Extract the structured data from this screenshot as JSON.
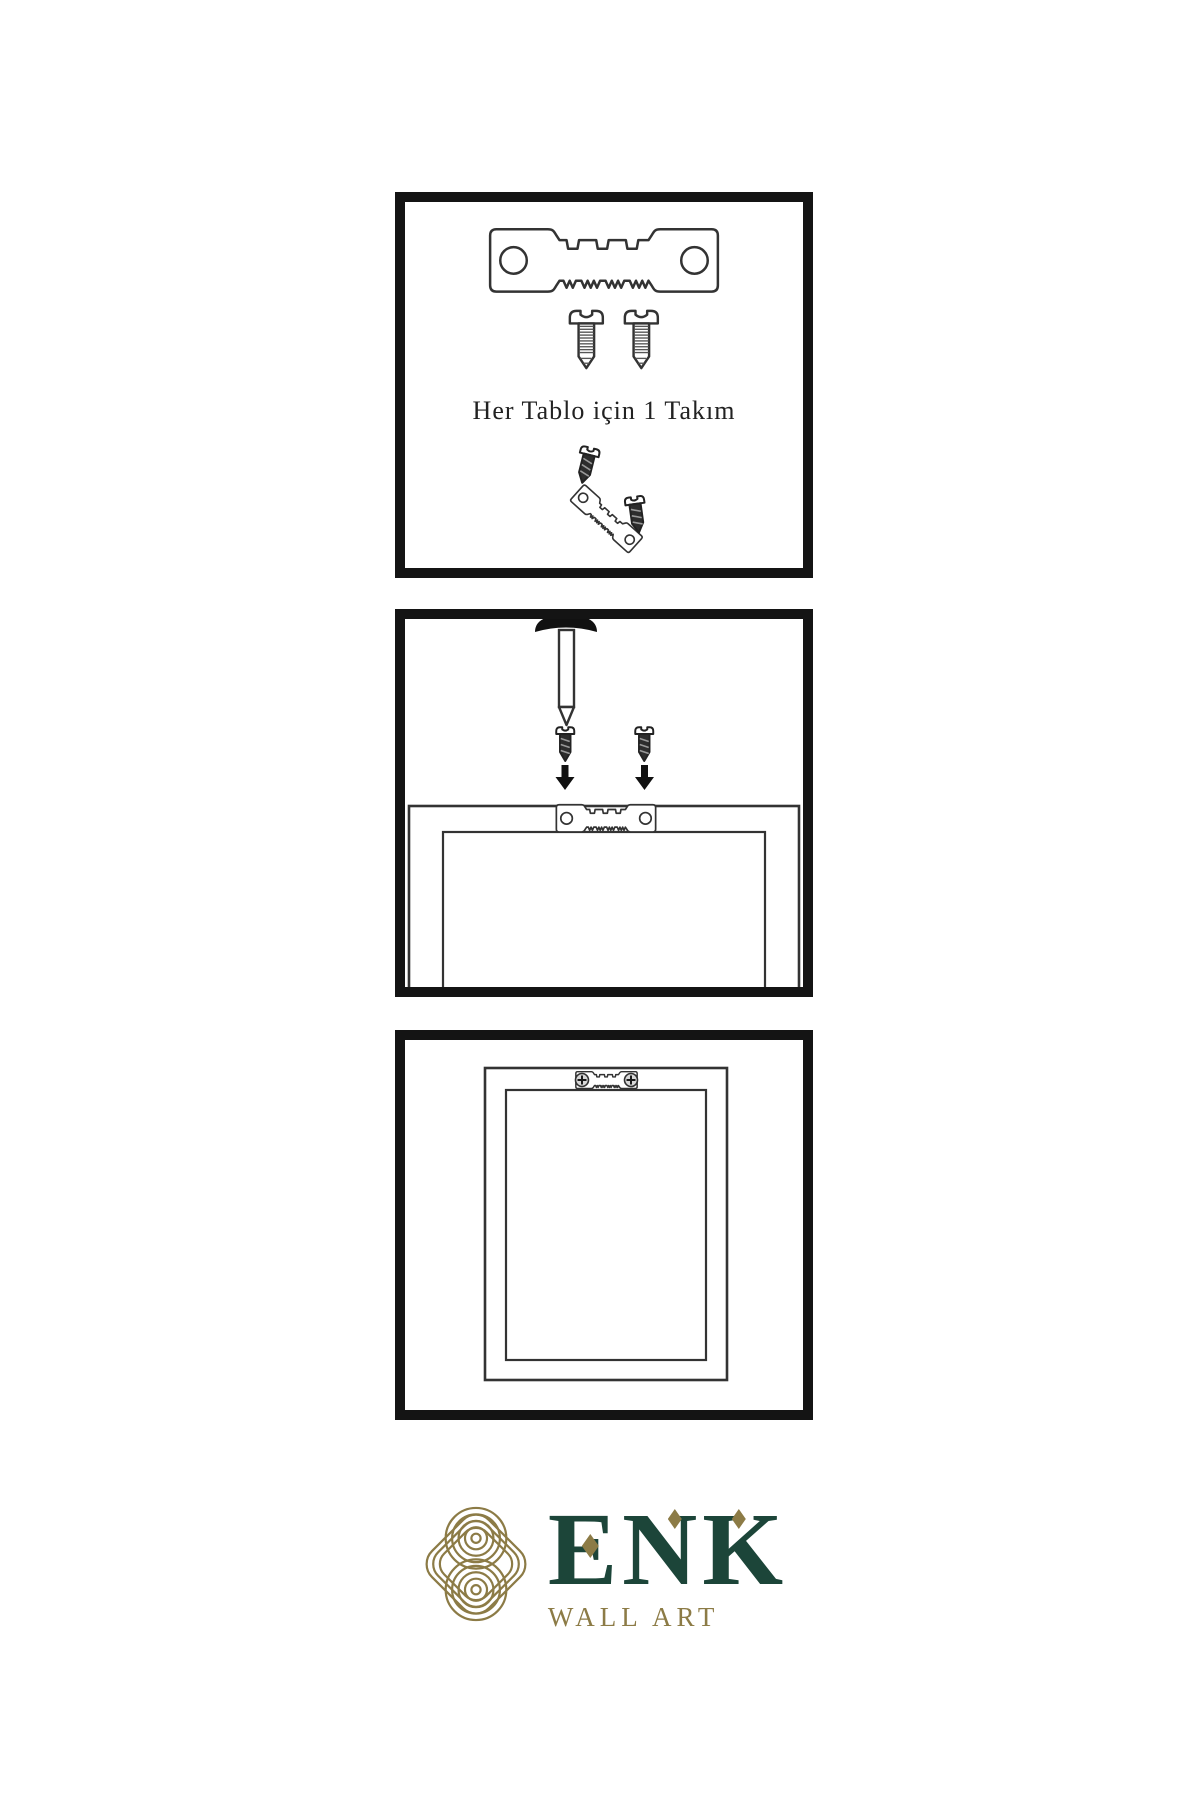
{
  "colors": {
    "panel_border": "#141414",
    "line": "#333333",
    "solid_black": "#111111",
    "logo_gold": "#8C7B46",
    "logo_green": "#1C4539"
  },
  "steps": [
    {
      "caption": "Her Tablo için 1 Takım",
      "icons": [
        "sawtooth-hanger-icon",
        "screw-icon",
        "screw-icon",
        "screw-dark-icon",
        "tilted-hanger-icon",
        "screw-dark-icon"
      ]
    },
    {
      "icons": [
        "wall-nail-icon",
        "screw-dark-icon",
        "screw-dark-icon",
        "arrow-down-icon",
        "arrow-down-icon",
        "sawtooth-hanger-icon",
        "frame-back-outline"
      ]
    },
    {
      "icons": [
        "frame-front-outline",
        "mounted-hanger-icon",
        "phillips-screw-head-icon",
        "phillips-screw-head-icon"
      ]
    }
  ],
  "logo": {
    "brand": "ENK",
    "subtitle": "WALL ART",
    "knot_icon": "celtic-knot-icon"
  }
}
